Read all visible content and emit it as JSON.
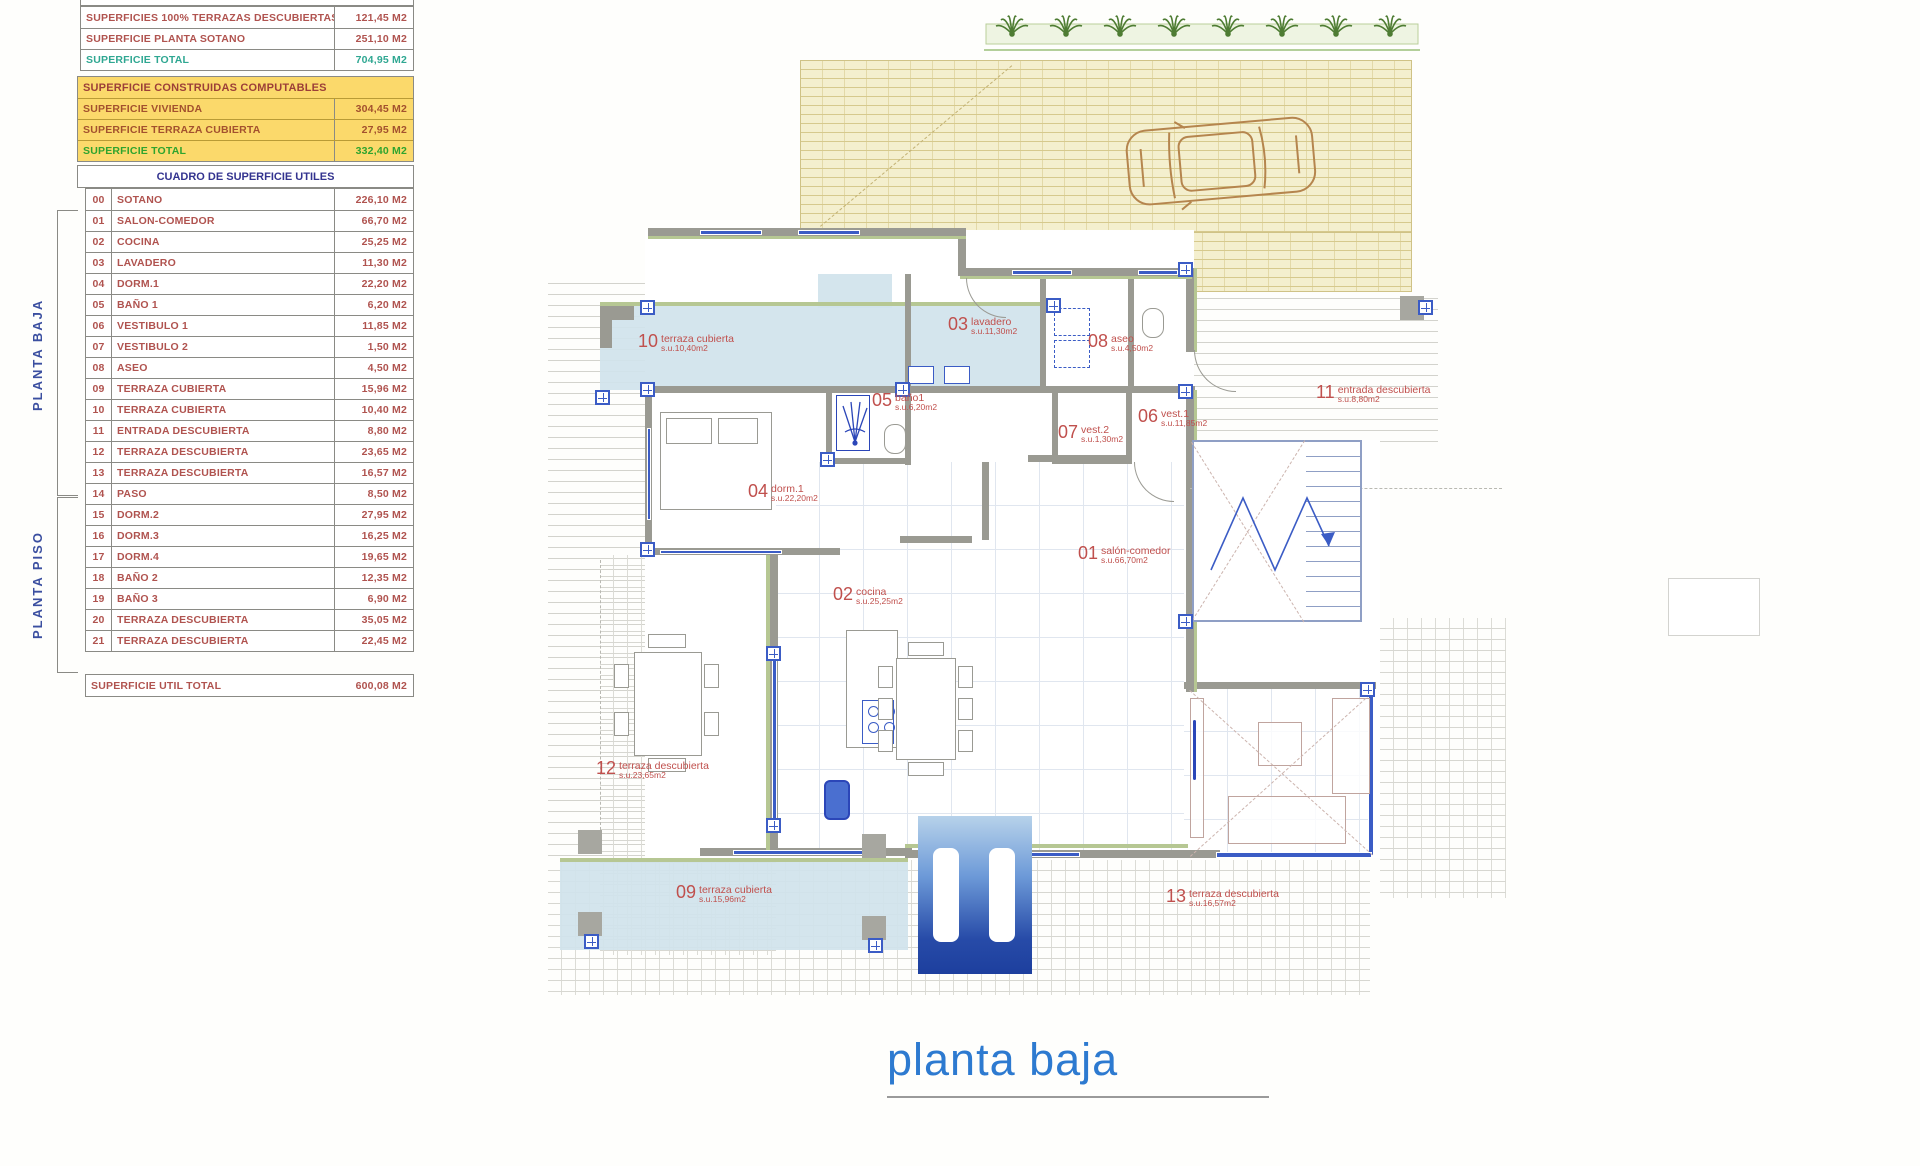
{
  "doc_title": "planta baja",
  "summary_table": {
    "rows": [
      {
        "label": "SUPERFICIES 100% TERRAZAS DESCUBIERTAS",
        "value": "121,45 M2",
        "color": "#b0534f"
      },
      {
        "label": "SUPERFICIE PLANTA SOTANO",
        "value": "251,10 M2",
        "color": "#b0534f"
      },
      {
        "label": "SUPERFICIE TOTAL",
        "value": "704,95 M2",
        "color": "#2fa792"
      }
    ]
  },
  "computables_table": {
    "header": "SUPERFICIE CONSTRUIDAS COMPUTABLES",
    "header_color": "#9c3f38",
    "rows": [
      {
        "label": "SUPERFICIE VIVIENDA",
        "value": "304,45 M2",
        "color": "#a3512e"
      },
      {
        "label": "SUPERFICIE TERRAZA CUBIERTA",
        "value": "27,95 M2",
        "color": "#a3512e"
      },
      {
        "label": "SUPERFICIE TOTAL",
        "value": "332,40 M2",
        "color": "#2fa42e"
      }
    ]
  },
  "utiles_table": {
    "header": "CUADRO DE SUPERFICIE UTILES",
    "header_color": "#33338f",
    "group_labels": {
      "baja": "PLANTA BAJA",
      "piso": "PLANTA PISO"
    },
    "rows": [
      {
        "num": "00",
        "label": "SOTANO",
        "value": "226,10 M2"
      },
      {
        "num": "01",
        "label": "SALON-COMEDOR",
        "value": "66,70 M2"
      },
      {
        "num": "02",
        "label": "COCINA",
        "value": "25,25 M2"
      },
      {
        "num": "03",
        "label": "LAVADERO",
        "value": "11,30 M2"
      },
      {
        "num": "04",
        "label": "DORM.1",
        "value": "22,20 M2"
      },
      {
        "num": "05",
        "label": "BAÑO 1",
        "value": "6,20 M2"
      },
      {
        "num": "06",
        "label": "VESTIBULO 1",
        "value": "11,85 M2"
      },
      {
        "num": "07",
        "label": "VESTIBULO 2",
        "value": "1,50 M2"
      },
      {
        "num": "08",
        "label": "ASEO",
        "value": "4,50 M2"
      },
      {
        "num": "09",
        "label": "TERRAZA CUBIERTA",
        "value": "15,96 M2"
      },
      {
        "num": "10",
        "label": "TERRAZA CUBIERTA",
        "value": "10,40 M2"
      },
      {
        "num": "11",
        "label": "ENTRADA DESCUBIERTA",
        "value": "8,80 M2"
      },
      {
        "num": "12",
        "label": "TERRAZA DESCUBIERTA",
        "value": "23,65 M2"
      },
      {
        "num": "13",
        "label": "TERRAZA DESCUBIERTA",
        "value": "16,57 M2"
      },
      {
        "num": "14",
        "label": "PASO",
        "value": "8,50 M2"
      },
      {
        "num": "15",
        "label": "DORM.2",
        "value": "27,95 M2"
      },
      {
        "num": "16",
        "label": "DORM.3",
        "value": "16,25 M2"
      },
      {
        "num": "17",
        "label": "DORM.4",
        "value": "19,65 M2"
      },
      {
        "num": "18",
        "label": "BAÑO 2",
        "value": "12,35 M2"
      },
      {
        "num": "19",
        "label": "BAÑO 3",
        "value": "6,90 M2"
      },
      {
        "num": "20",
        "label": "TERRAZA DESCUBIERTA",
        "value": "35,05 M2"
      },
      {
        "num": "21",
        "label": "TERRAZA DESCUBIERTA",
        "value": "22,45 M2"
      }
    ],
    "total_label": "SUPERFICIE UTIL TOTAL",
    "total_value": "600,08 M2"
  },
  "plan": {
    "title": "planta baja",
    "room_labels": [
      {
        "num": "01",
        "name": "salón-comedor",
        "area": "s.u.66,70m2",
        "x": 1078,
        "y": 545
      },
      {
        "num": "02",
        "name": "cocina",
        "area": "s.u.25,25m2",
        "x": 833,
        "y": 586
      },
      {
        "num": "03",
        "name": "lavadero",
        "area": "s.u.11,30m2",
        "x": 948,
        "y": 316
      },
      {
        "num": "04",
        "name": "dorm.1",
        "area": "s.u.22,20m2",
        "x": 748,
        "y": 483
      },
      {
        "num": "05",
        "name": "baño1",
        "area": "s.u.6,20m2",
        "x": 872,
        "y": 392
      },
      {
        "num": "06",
        "name": "vest.1",
        "area": "s.u.11,85m2",
        "x": 1138,
        "y": 408
      },
      {
        "num": "07",
        "name": "vest.2",
        "area": "s.u.1,30m2",
        "x": 1058,
        "y": 424
      },
      {
        "num": "08",
        "name": "aseo",
        "area": "s.u.4,50m2",
        "x": 1088,
        "y": 333
      },
      {
        "num": "09",
        "name": "terraza cubierta",
        "area": "s.u.15,96m2",
        "x": 676,
        "y": 884
      },
      {
        "num": "10",
        "name": "terraza cubierta",
        "area": "s.u.10,40m2",
        "x": 638,
        "y": 333
      },
      {
        "num": "11",
        "name": "entrada descubierta",
        "area": "s.u.8,80m2",
        "x": 1316,
        "y": 384
      },
      {
        "num": "12",
        "name": "terraza descubierta",
        "area": "s.u.23,65m2",
        "x": 596,
        "y": 760
      },
      {
        "num": "13",
        "name": "terraza descubierta",
        "area": "s.u.16,57m2",
        "x": 1166,
        "y": 888
      }
    ],
    "colors": {
      "label": "#c0504d",
      "wall": "#9a9a92",
      "window": "#3b5cc5",
      "terrace_fill": "#d0e3ec",
      "hatch_fill": "#f4efce",
      "pool_dark": "#1d3f9e",
      "title_blue": "#2d7ad0",
      "palm_green": "#4e7c33",
      "car_tan": "#b5854e"
    }
  }
}
